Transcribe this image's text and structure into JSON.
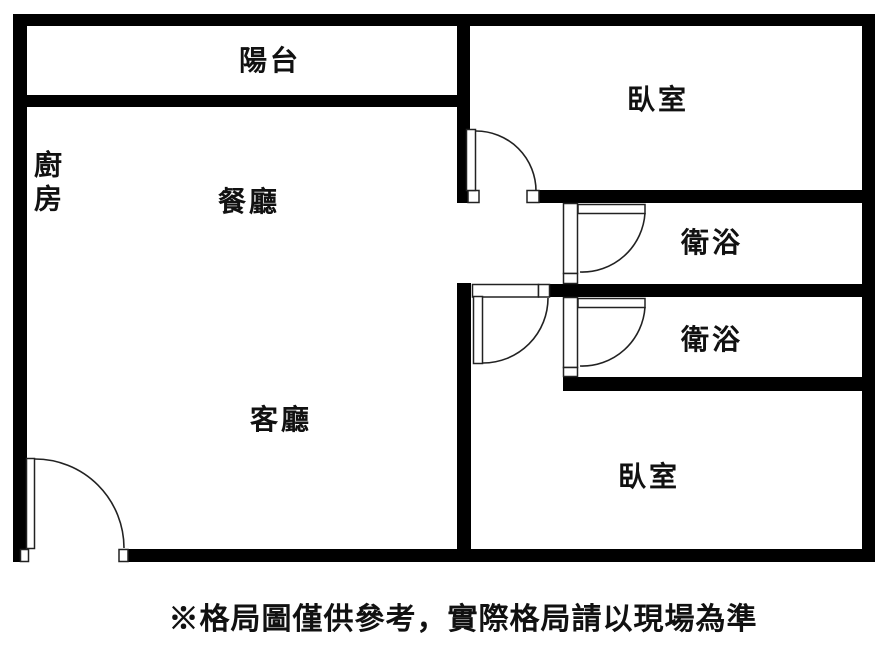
{
  "floor_plan": {
    "rooms": [
      {
        "id": "balcony",
        "label": "陽台"
      },
      {
        "id": "bedroom-top",
        "label": "臥室"
      },
      {
        "id": "kitchen",
        "label": "廚房"
      },
      {
        "id": "dining",
        "label": "餐廳"
      },
      {
        "id": "bathroom-upper",
        "label": "衛浴"
      },
      {
        "id": "bathroom-lower",
        "label": "衛浴"
      },
      {
        "id": "living",
        "label": "客廳"
      },
      {
        "id": "bedroom-bottom",
        "label": "臥室"
      }
    ],
    "colors": {
      "wall": "#000000",
      "background": "#ffffff",
      "door_line": "#222222",
      "text": "#111111"
    }
  },
  "footer": {
    "disclaimer": "※格局圖僅供參考，實際格局請以現場為準"
  }
}
